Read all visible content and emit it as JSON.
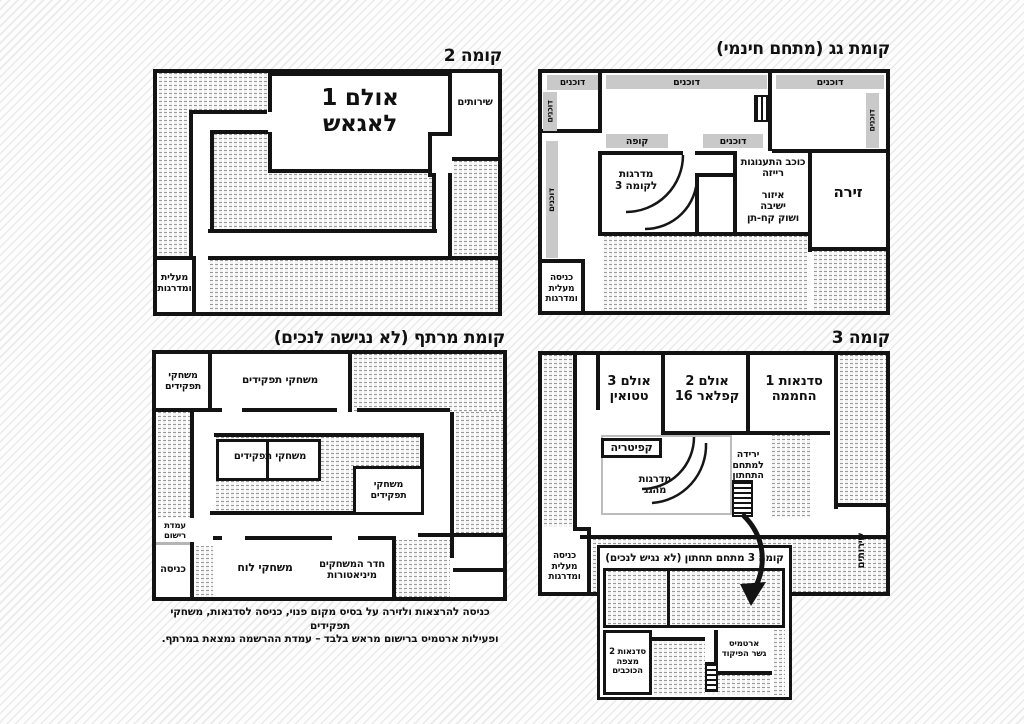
{
  "floor2": {
    "title": "קומה 2",
    "hall1": "אולם 1\nלאגאש",
    "toilets": "שירותים",
    "elevator_stairs": "מעלית\nומדרגות"
  },
  "roof": {
    "title": "קומת גג (מתחם חינמי)",
    "booths": "דוכנים",
    "cashier": "קופה",
    "stairs_to_floor3": "מדרגות\nלקומה 3",
    "pleasure_star": "כוכב התענוגות\nרייזה",
    "seating_market": "איזור\nישיבה\nושוק קח-תן",
    "arena": "זירה",
    "entrance_elevator_stairs": "כניסה\nמעלית\nומדרגות"
  },
  "floor3": {
    "title": "קומה 3",
    "workshops1": "סדנאות 1\nהחממה",
    "hall2": "אולם 2\nקפלאר 16",
    "hall3": "אולם 3\nטטואין",
    "cafeteria": "קפיטריה",
    "stairs_from_roof": "מדרגות\nמהגג",
    "descent_to_lower": "ירידה\nלמתחם\nהתחתון",
    "toilets": "שירותים",
    "entrance_elevator_stairs": "כניסה\nמעלית\nומדרגות"
  },
  "floor3_lower": {
    "title": "קומה 3 מתחם תחתון (לא נגיש לנכים)",
    "workshops2": "סדנאות 2\nמצפה\nהכוכבים",
    "artemis": "ארטמיס\nגשר הפיקוד"
  },
  "basement": {
    "title": "קומת מרתף (לא נגישה לנכים)",
    "rpg": "משחקי תפקידים",
    "rpg_stacked": "משחקי\nתפקידים",
    "registration": "עמדת\nרישום",
    "entrance": "כניסה",
    "board_games": "משחקי לוח",
    "miniatures_room": "חדר המשחקים\nמיניאטורות",
    "caption": "כניסה להרצאות ולזירה על בסיס מקום פנוי, כניסה לסדנאות, משחקי תפקידים\nופעילות ארטמיס ברישום מראש בלבד – עמדת ההרשמה נמצאת במרתף."
  },
  "colors": {
    "wall": "#131313",
    "label_bg": "#c9c9c9"
  }
}
